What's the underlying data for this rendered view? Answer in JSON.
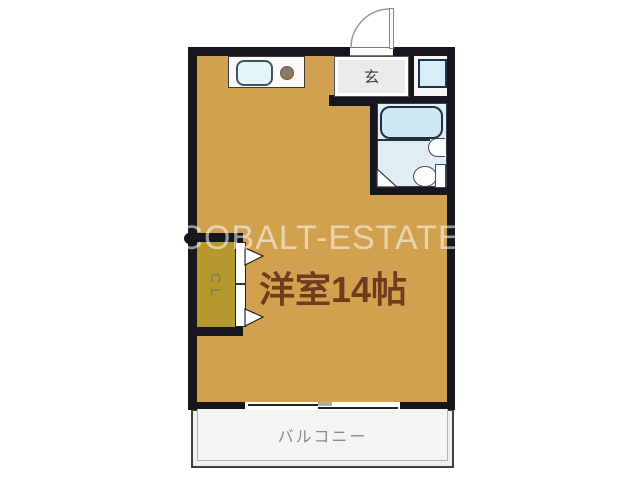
{
  "floorplan": {
    "watermark": "COBALT-ESTATE",
    "main_room": {
      "label": "洋室14帖"
    },
    "entrance": {
      "label": "玄"
    },
    "balcony": {
      "label": "バルコニー"
    },
    "closet": {
      "char_top": "C",
      "char_bottom": "L"
    },
    "fixtures": [
      "kitchen-sink-icon",
      "stove-burner-icon",
      "washing-machine-icon",
      "bathtub-icon",
      "wash-basin-icon",
      "toilet-icon",
      "entrance-door-swing-icon",
      "closet-folding-door-icon",
      "sliding-window-icon"
    ],
    "colors": {
      "wall": "#16161f",
      "room_floor": "#d1a150",
      "closet_floor": "#b5992e",
      "bathroom_floor": "#e0edf4",
      "fixture_blue": "#d5eef7",
      "entrance_floor": "#ebebeb",
      "balcony_floor": "#efefef",
      "room_label_text": "#6e3d1d",
      "watermark_text": "rgba(255,255,255,0.55)"
    }
  }
}
